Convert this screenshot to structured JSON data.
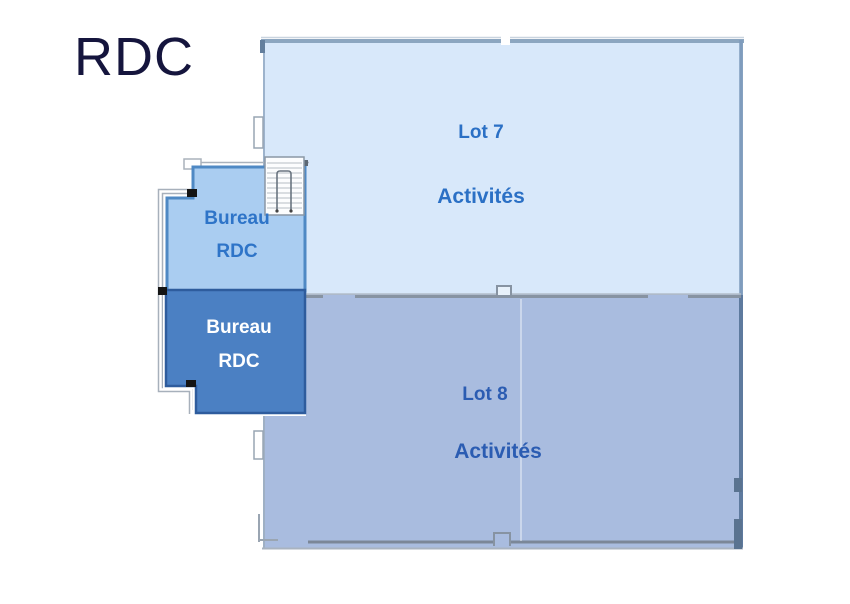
{
  "title": "RDC",
  "plan": {
    "lot7": {
      "name": "Lot 7",
      "category": "Activités"
    },
    "lot8": {
      "name": "Lot 8",
      "category": "Activités"
    },
    "bureau_upper": {
      "line1": "Bureau",
      "line2": "RDC"
    },
    "bureau_lower": {
      "line1": "Bureau",
      "line2": "RDC"
    }
  },
  "colors": {
    "lot7_fill": "#d8e8fa",
    "lot8_fill": "#a9bcdf",
    "bureau_upper_fill": "#aacdf1",
    "bureau_lower_fill": "#4b80c3",
    "label_blue": "#2b70c5",
    "lot8_label_blue": "#2b5cb2",
    "title_color": "#15153d",
    "wall_grey": "#8793a2"
  }
}
